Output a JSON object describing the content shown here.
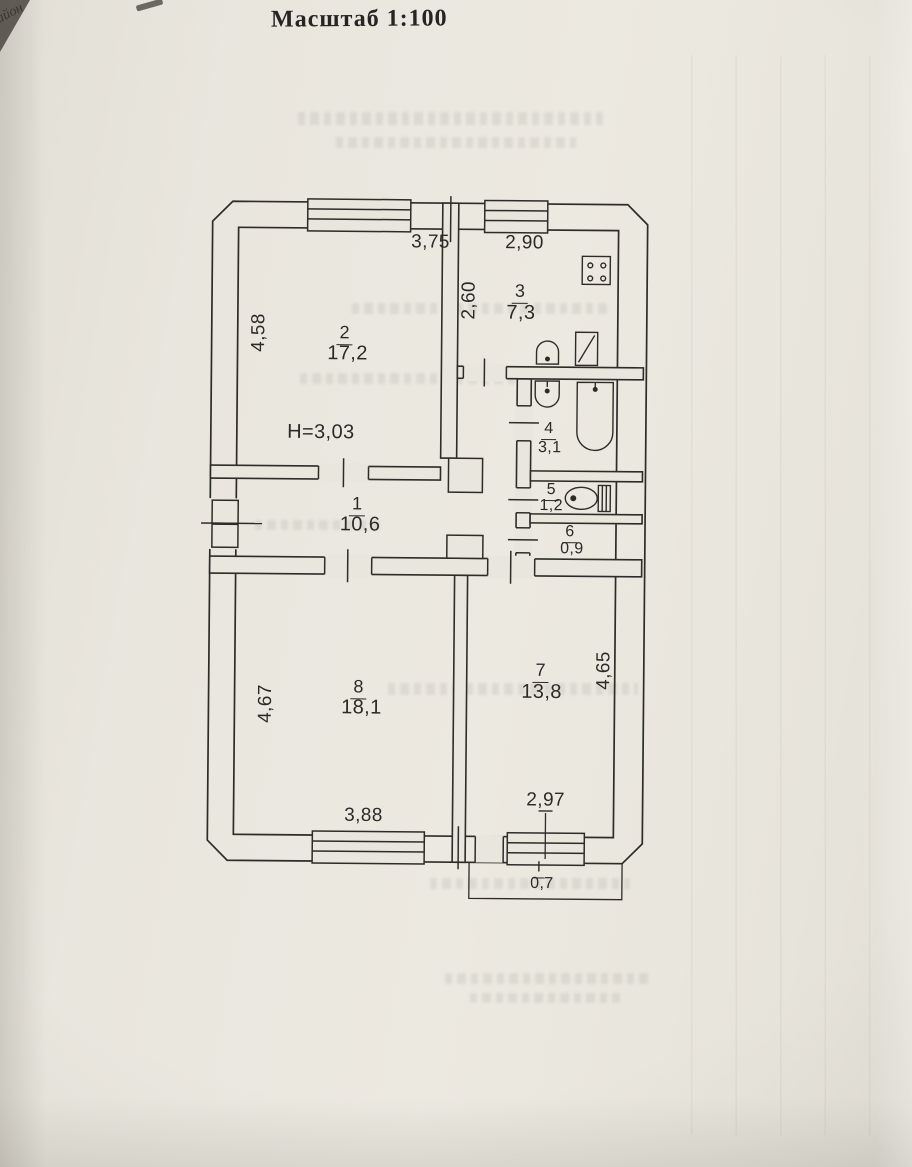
{
  "page": {
    "title": "Масштаб 1:100",
    "corner_text": "айон"
  },
  "plan": {
    "ceiling_height": "H=3,03",
    "rooms": [
      {
        "number": "1",
        "area": "10,6"
      },
      {
        "number": "2",
        "area": "17,2"
      },
      {
        "number": "3",
        "area": "7,3"
      },
      {
        "number": "4",
        "area": "3,1"
      },
      {
        "number": "5",
        "area": "1,2"
      },
      {
        "number": "6",
        "area": "0,9"
      },
      {
        "number": "7",
        "area": "13,8"
      },
      {
        "number": "8",
        "area": "18,1"
      }
    ],
    "balcony": {
      "number": "I",
      "area": "0,7"
    },
    "dimensions": {
      "room2_width": "3,75",
      "kitchen_width": "2,90",
      "kitchen_depth": "2,60",
      "room2_depth": "4,58",
      "room8_depth": "4,67",
      "room7_depth": "4,65",
      "room8_width": "3,88",
      "room7_width": "2,97"
    },
    "colors": {
      "paper": "#e9e6de",
      "ink": "#2e2c29"
    }
  }
}
